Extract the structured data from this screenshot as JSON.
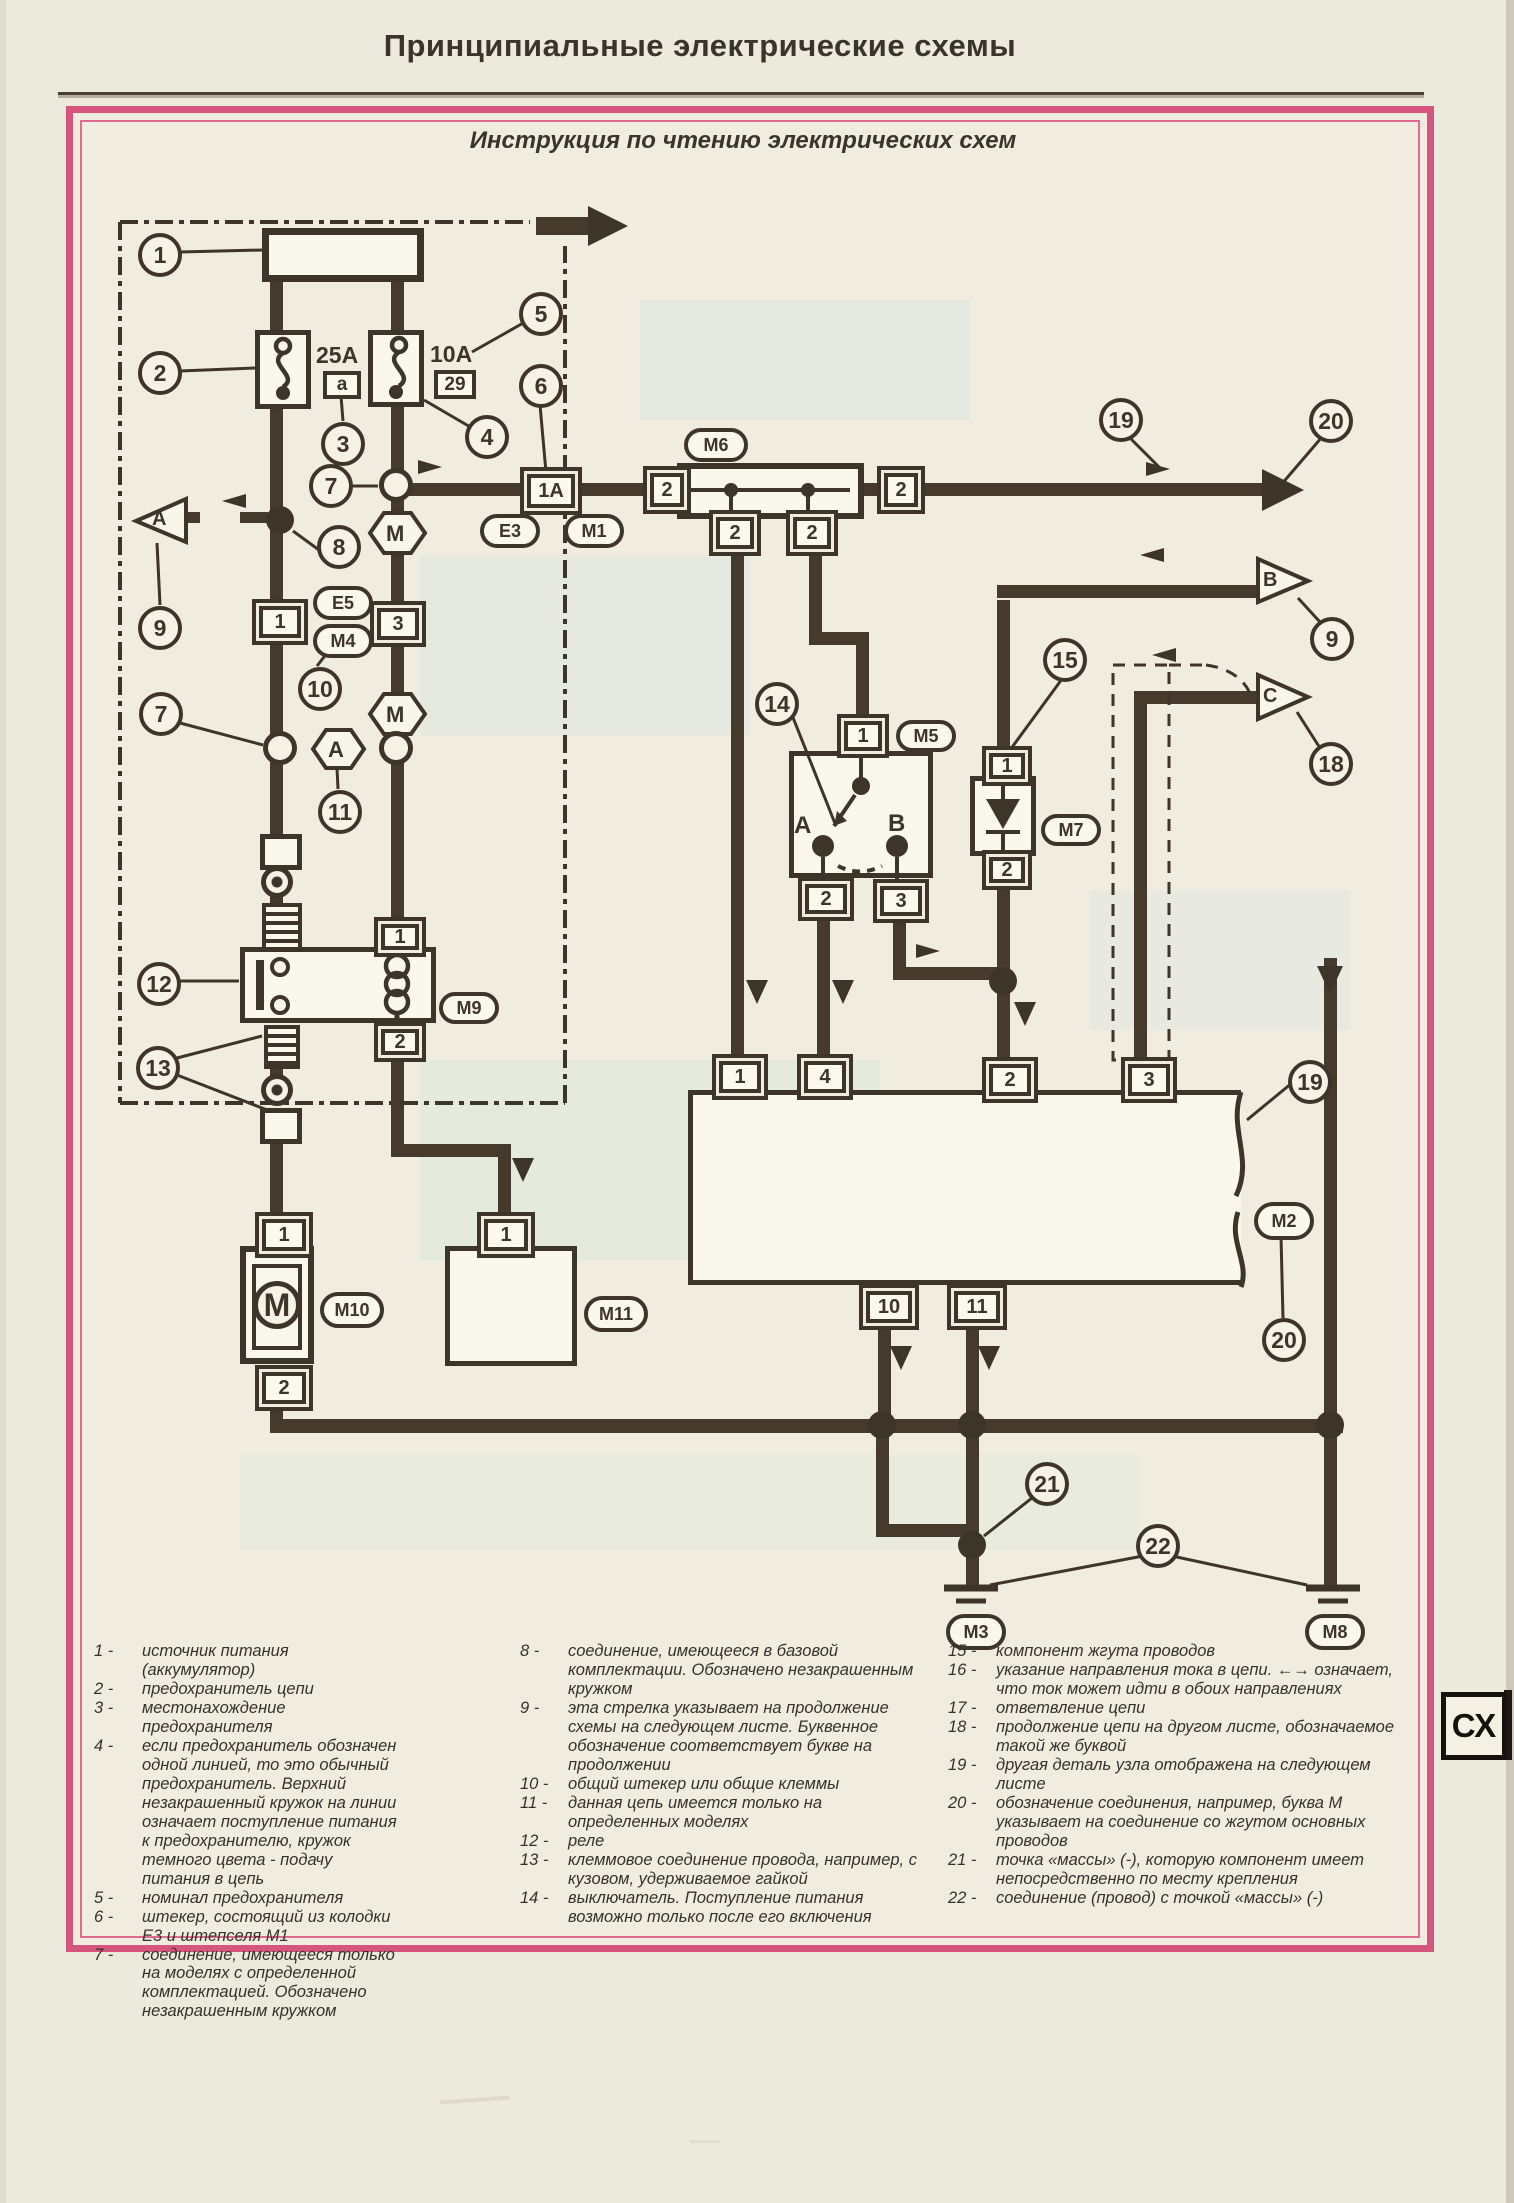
{
  "page": {
    "header_title": "Принципиальные электрические схемы",
    "frame_title": "Инструкция по чтению электрических схем",
    "side_tab": "СХ"
  },
  "diagram": {
    "callouts": {
      "n1": "1",
      "n2": "2",
      "n3": "3",
      "n4": "4",
      "n5": "5",
      "n6": "6",
      "n7": "7",
      "n8": "8",
      "n9": "9",
      "n10": "10",
      "n11": "11",
      "n12": "12",
      "n13": "13",
      "n14": "14",
      "n15": "15",
      "n18": "18",
      "n19": "19",
      "n20": "20",
      "n21": "21",
      "n22": "22"
    },
    "pins": {
      "p1": "1",
      "p2": "2",
      "p3": "3",
      "p4": "4",
      "p10": "10",
      "p11": "11",
      "p1a": "1A",
      "pa": "a",
      "p29": "29"
    },
    "fuse_ratings": {
      "f1": "25A",
      "f2": "10A"
    },
    "letters": {
      "m": "M",
      "a": "A",
      "b": "B",
      "c": "C"
    },
    "connectors": {
      "m1": "M1",
      "m2": "M2",
      "m3": "M3",
      "m4": "M4",
      "m5": "M5",
      "m6": "M6",
      "m7": "M7",
      "m8": "M8",
      "m9": "M9",
      "m10": "M10",
      "m11": "M11",
      "e3": "E3",
      "e5": "E5"
    }
  },
  "legend": {
    "col1": [
      {
        "n": "1 -",
        "t": "источник питания (аккумулятор)"
      },
      {
        "n": "2 -",
        "t": "предохранитель цепи"
      },
      {
        "n": "3 -",
        "t": "местонахождение предохранителя"
      },
      {
        "n": "4 -",
        "t": "если предохранитель обозначен одной линией, то это обычный предохранитель. Верхний незакрашенный кружок на линии означает поступление питания к предохранителю, кружок темного цвета - подачу питания в цепь"
      },
      {
        "n": "5 -",
        "t": "номинал предохранителя"
      },
      {
        "n": "6 -",
        "t": "штекер, состоящий из колодки Е3 и штепселя М1"
      },
      {
        "n": "7 -",
        "t": "соединение, имеющееся только на моделях с определенной комплектацией. Обозначено незакрашенным кружком"
      }
    ],
    "col2": [
      {
        "n": "8 -",
        "t": "соединение, имеющееся в базовой комплектации. Обозначено незакрашенным кружком"
      },
      {
        "n": "9 -",
        "t": "эта стрелка указывает на продолжение схемы на следующем листе. Буквенное обозначение соответствует букве на продолжении"
      },
      {
        "n": "10 -",
        "t": "общий штекер или общие клеммы"
      },
      {
        "n": "11 -",
        "t": "данная цепь имеется только на определенных моделях"
      },
      {
        "n": "12 -",
        "t": "реле"
      },
      {
        "n": "13 -",
        "t": "клеммовое соединение провода, например, с кузовом, удерживаемое гайкой"
      },
      {
        "n": "14 -",
        "t": "выключатель. Поступление питания возможно только после его включения"
      }
    ],
    "col3": [
      {
        "n": "15 -",
        "t": "компонент жгута проводов"
      },
      {
        "n": "16 -",
        "t": "указание направления тока в цепи. ←→ означает, что ток может идти в обоих направлениях"
      },
      {
        "n": "17 -",
        "t": "ответвление цепи"
      },
      {
        "n": "18 -",
        "t": "продолжение цепи на другом листе, обозначаемое такой же буквой"
      },
      {
        "n": "19 -",
        "t": "другая деталь узла отображена на следующем листе"
      },
      {
        "n": "20 -",
        "t": "обозначение соединения, например, буква М указывает на соединение со жгутом основных проводов"
      },
      {
        "n": "21 -",
        "t": "точка «массы» (-), которую компонент имеет непосредственно по месту крепления"
      },
      {
        "n": "22 -",
        "t": "соединение (провод) с точкой «массы» (-)"
      }
    ]
  }
}
